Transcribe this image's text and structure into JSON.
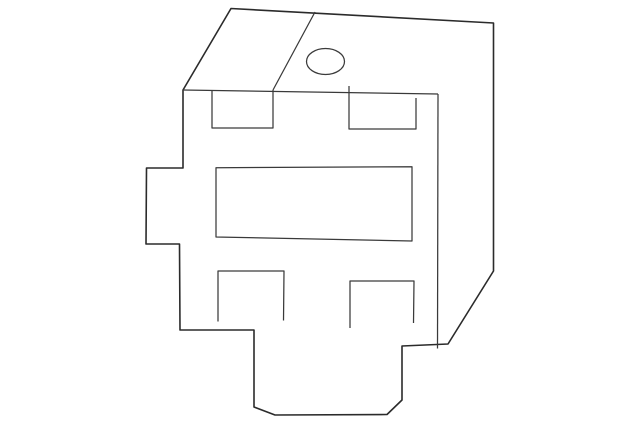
{
  "page": {
    "background": "#ffffff",
    "width": 640,
    "height": 425
  },
  "diagram": {
    "description": "isometric technical line drawing of a relay / bracket part with slots and a mounting hole",
    "canvas": {
      "width": 640,
      "height": 425
    },
    "style": {
      "outline_color": "#2b2b2b",
      "outline_width": 1.6,
      "detail_color": "#3a3a3a",
      "detail_width": 1.25,
      "fill": "#ffffff"
    },
    "shapes": [
      {
        "name": "part-silhouette",
        "type": "polygon",
        "role": "outline",
        "points": [
          [
            183,
            90
          ],
          [
            231,
            8.5
          ],
          [
            493.5,
            23
          ],
          [
            493.5,
            271
          ],
          [
            448,
            344
          ],
          [
            402,
            346
          ],
          [
            402,
            400
          ],
          [
            387,
            414.5
          ],
          [
            275,
            415
          ],
          [
            254,
            407
          ],
          [
            254,
            330
          ],
          [
            180,
            330
          ],
          [
            179.5,
            244
          ],
          [
            146,
            244
          ],
          [
            146.5,
            168
          ],
          [
            183,
            168
          ]
        ]
      },
      {
        "name": "front-top-edge",
        "type": "polyline",
        "points": [
          [
            183,
            90
          ],
          [
            438,
            94
          ]
        ]
      },
      {
        "name": "front-right-edge",
        "type": "polyline",
        "points": [
          [
            438,
            94
          ],
          [
            437.5,
            348.5
          ]
        ]
      },
      {
        "name": "top-face-fold-edge",
        "type": "polyline",
        "points": [
          [
            315,
            12
          ],
          [
            273,
            90
          ]
        ]
      },
      {
        "name": "upper-left-slot",
        "type": "polyline",
        "points": [
          [
            212,
            91
          ],
          [
            212,
            128
          ],
          [
            273,
            128
          ],
          [
            273,
            90
          ]
        ]
      },
      {
        "name": "upper-right-slot",
        "type": "polyline",
        "points": [
          [
            349,
            86
          ],
          [
            349,
            129
          ],
          [
            416,
            129
          ],
          [
            416,
            98
          ]
        ]
      },
      {
        "name": "center-connector-slot",
        "type": "polygon",
        "role": "detail-closed",
        "points": [
          [
            216,
            167.7
          ],
          [
            412,
            166.7
          ],
          [
            412,
            241
          ],
          [
            216,
            237
          ]
        ]
      },
      {
        "name": "lower-left-slot",
        "type": "polyline",
        "points": [
          [
            218,
            321.5
          ],
          [
            218,
            271
          ],
          [
            284,
            271
          ],
          [
            283.5,
            320.5
          ]
        ]
      },
      {
        "name": "lower-right-slot",
        "type": "polyline",
        "points": [
          [
            350,
            328
          ],
          [
            350,
            281
          ],
          [
            414,
            281
          ],
          [
            413.5,
            323
          ]
        ]
      },
      {
        "name": "mounting-hole",
        "type": "ellipse",
        "cx": 325.5,
        "cy": 61.5,
        "rx": 19,
        "ry": 13
      }
    ]
  }
}
